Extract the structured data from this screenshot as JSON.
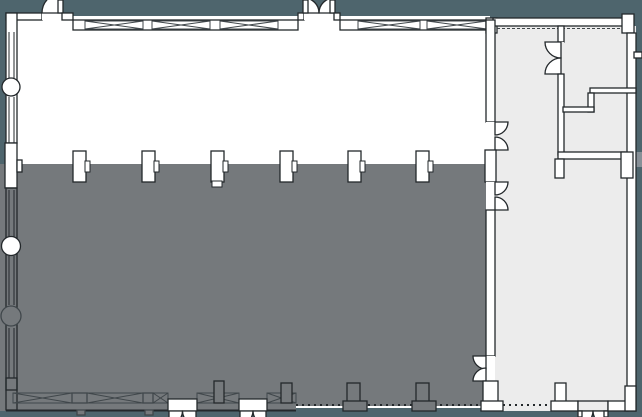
{
  "canvas": {
    "width": 642,
    "height": 417,
    "background": "#4e656d"
  },
  "palette": {
    "bg": "#4e656d",
    "floor": "#ffffff",
    "annex": "#ececec",
    "shade": "#75797c",
    "wall": "#ffffff",
    "line": "#23282b",
    "soft": "#40474b",
    "ghost": "#879097",
    "none": "none"
  },
  "regions": {
    "main_hall": {
      "x": 6,
      "y": 13,
      "w": 489,
      "h": 398
    },
    "shaded_zone": {
      "x": 0,
      "y": 164,
      "w": 486,
      "h": 247
    },
    "annex_wing": {
      "x": 486,
      "y": 14,
      "w": 156,
      "h": 397
    },
    "column_row_y": 151,
    "column_centers_x": [
      79,
      148,
      217,
      286,
      354,
      422
    ]
  },
  "floorplan": {
    "elements": [
      {
        "n": "main-hall-floor",
        "t": "rect",
        "x": 8,
        "y": 16,
        "w": 482,
        "h": 392,
        "f": "floor"
      },
      {
        "n": "annex-floor",
        "t": "rect",
        "x": 495,
        "y": 26,
        "w": 141,
        "h": 385,
        "f": "annex"
      },
      {
        "n": "shaded-zone",
        "t": "path",
        "d": "M0 164 H486 V406 H296 V411 H0 Z",
        "f": "shade"
      },
      {
        "n": "exterior-ledge",
        "t": "rect",
        "x": 636,
        "y": 152,
        "w": 6,
        "h": 15,
        "f": "ghost"
      },
      {
        "n": "wall-top-west",
        "t": "rect",
        "x": 6,
        "y": 13,
        "w": 36,
        "h": 7,
        "f": "wall",
        "s": "line"
      },
      {
        "n": "door-nw-threshold",
        "t": "rect",
        "x": 42,
        "y": 13,
        "w": 20,
        "h": 7,
        "f": "wall"
      },
      {
        "n": "door-nw-swing",
        "t": "path",
        "d": "M42 13 A20 20 0 0 1 62 -7 L62 13 Z",
        "f": "wall",
        "s": "line"
      },
      {
        "n": "door-nw-leaf",
        "t": "rect",
        "x": 58,
        "y": 0,
        "w": 5,
        "h": 13,
        "f": "wall",
        "s": "line"
      },
      {
        "n": "wall-top-a",
        "t": "rect",
        "x": 62,
        "y": 13,
        "w": 11,
        "h": 7,
        "f": "wall",
        "s": "line"
      },
      {
        "n": "window-band-top-west",
        "t": "rect",
        "x": 73,
        "y": 20,
        "w": 225,
        "h": 10,
        "f": "wall",
        "s": "line"
      },
      {
        "n": "window-x-panel",
        "t": "xpanel",
        "x": 85,
        "y": 21,
        "w": 58,
        "h": 8,
        "s": "soft"
      },
      {
        "n": "window-x-panel",
        "t": "xpanel",
        "x": 152,
        "y": 21,
        "w": 58,
        "h": 8,
        "s": "soft"
      },
      {
        "n": "window-x-panel",
        "t": "xpanel",
        "x": 220,
        "y": 21,
        "w": 58,
        "h": 8,
        "s": "soft"
      },
      {
        "n": "door-n-pier-west",
        "t": "rect",
        "x": 298,
        "y": 13,
        "w": 6,
        "h": 7,
        "f": "wall",
        "s": "line"
      },
      {
        "n": "door-n-threshold",
        "t": "rect",
        "x": 304,
        "y": 13,
        "w": 30,
        "h": 7,
        "f": "wall"
      },
      {
        "n": "door-n-swing-west",
        "t": "path",
        "d": "M319 13 A15 15 0 0 0 304 -2 L304 13 Z",
        "f": "wall",
        "s": "line"
      },
      {
        "n": "door-n-swing-east",
        "t": "path",
        "d": "M319 13 A15 15 0 0 1 334 -2 L334 13 Z",
        "f": "wall",
        "s": "line"
      },
      {
        "n": "door-n-leaf-west",
        "t": "rect",
        "x": 303,
        "y": 0,
        "w": 5,
        "h": 13,
        "f": "wall",
        "s": "line"
      },
      {
        "n": "door-n-leaf-east",
        "t": "rect",
        "x": 330,
        "y": 0,
        "w": 5,
        "h": 13,
        "f": "wall",
        "s": "line"
      },
      {
        "n": "door-n-pier-east",
        "t": "rect",
        "x": 334,
        "y": 13,
        "w": 6,
        "h": 7,
        "f": "wall",
        "s": "line"
      },
      {
        "n": "window-band-top-east",
        "t": "rect",
        "x": 340,
        "y": 20,
        "w": 153,
        "h": 10,
        "f": "wall",
        "s": "line"
      },
      {
        "n": "window-x-panel",
        "t": "xpanel",
        "x": 358,
        "y": 21,
        "w": 62,
        "h": 8,
        "s": "soft"
      },
      {
        "n": "window-x-panel",
        "t": "xpanel",
        "x": 427,
        "y": 21,
        "w": 60,
        "h": 8,
        "s": "soft"
      },
      {
        "n": "wall-annex-junction",
        "t": "rect",
        "x": 486,
        "y": 18,
        "w": 11,
        "h": 15,
        "f": "wall",
        "s": "line"
      },
      {
        "n": "wall-annex-top",
        "t": "rect",
        "x": 493,
        "y": 18,
        "w": 131,
        "h": 8,
        "f": "wall",
        "s": "line"
      },
      {
        "n": "annex-top-dashed",
        "t": "line",
        "x1": 497,
        "y1": 28.5,
        "x2": 620,
        "y2": 28.5,
        "s": "soft",
        "dash": "3 2"
      },
      {
        "n": "wall-ne-pier",
        "t": "rect",
        "x": 622,
        "y": 14,
        "w": 12,
        "h": 19,
        "f": "wall",
        "s": "line"
      },
      {
        "n": "wall-east",
        "t": "rect",
        "x": 627,
        "y": 33,
        "w": 9,
        "h": 378,
        "f": "wall",
        "s": "line"
      },
      {
        "n": "wall-ne-notch",
        "t": "rect",
        "x": 634,
        "y": 52,
        "w": 8,
        "h": 6,
        "f": "wall",
        "s": "line"
      },
      {
        "n": "wall-annex-v1-upper",
        "t": "rect",
        "x": 558,
        "y": 26,
        "w": 6,
        "h": 16,
        "f": "wall",
        "s": "line"
      },
      {
        "n": "door-annex-threshold",
        "t": "rect",
        "x": 558,
        "y": 42,
        "w": 6,
        "h": 32,
        "f": "annex"
      },
      {
        "n": "door-annex-swing-top",
        "t": "path",
        "d": "M545 42 A16 16 0 0 0 561 58 L561 42 Z",
        "f": "wall",
        "s": "line"
      },
      {
        "n": "door-annex-swing-bottom",
        "t": "path",
        "d": "M545 74 A16 16 0 0 1 561 58 L561 74 Z",
        "f": "wall",
        "s": "line"
      },
      {
        "n": "wall-annex-v1-lower",
        "t": "rect",
        "x": 558,
        "y": 74,
        "w": 6,
        "h": 81,
        "f": "wall",
        "s": "line"
      },
      {
        "n": "wall-annex-h1",
        "t": "rect",
        "x": 558,
        "y": 152,
        "w": 67,
        "h": 7,
        "f": "wall",
        "s": "line"
      },
      {
        "n": "wall-annex-h1-stub",
        "t": "rect",
        "x": 555,
        "y": 159,
        "w": 9,
        "h": 19,
        "f": "wall",
        "s": "line"
      },
      {
        "n": "wall-annex-h1-pier",
        "t": "rect",
        "x": 621,
        "y": 152,
        "w": 12,
        "h": 26,
        "f": "wall",
        "s": "line"
      },
      {
        "n": "wall-annex-step-a",
        "t": "rect",
        "x": 590,
        "y": 88,
        "w": 46,
        "h": 5,
        "f": "wall",
        "s": "line"
      },
      {
        "n": "wall-annex-step-b",
        "t": "rect",
        "x": 588,
        "y": 93,
        "w": 6,
        "h": 19,
        "f": "wall",
        "s": "line"
      },
      {
        "n": "wall-annex-step-c",
        "t": "rect",
        "x": 563,
        "y": 107,
        "w": 31,
        "h": 5,
        "f": "wall",
        "s": "line"
      },
      {
        "n": "wall-divide-upper",
        "t": "rect",
        "x": 486,
        "y": 20,
        "w": 9,
        "h": 102,
        "f": "wall",
        "s": "line"
      },
      {
        "n": "door-divide1-threshold",
        "t": "rect",
        "x": 486,
        "y": 122,
        "w": 9,
        "h": 28,
        "f": "wall"
      },
      {
        "n": "door-divide1-swing-top",
        "t": "path",
        "d": "M508 122 A13 13 0 0 1 495 135 L495 122 Z",
        "f": "wall",
        "s": "line"
      },
      {
        "n": "door-divide1-swing-bottom",
        "t": "path",
        "d": "M508 150 A13 13 0 0 0 495 137 L495 150 Z",
        "f": "wall",
        "s": "line"
      },
      {
        "n": "column-divide-pier",
        "t": "rect",
        "x": 485,
        "y": 150,
        "w": 11,
        "h": 32,
        "f": "wall",
        "s": "line"
      },
      {
        "n": "door-divide2-threshold",
        "t": "rect",
        "x": 486,
        "y": 182,
        "w": 9,
        "h": 28,
        "f": "wall"
      },
      {
        "n": "door-divide2-swing-top",
        "t": "path",
        "d": "M508 182 A13 13 0 0 1 495 195 L495 182 Z",
        "f": "wall",
        "s": "line"
      },
      {
        "n": "door-divide2-swing-bottom",
        "t": "path",
        "d": "M508 210 A13 13 0 0 0 495 197 L495 210 Z",
        "f": "wall",
        "s": "line"
      },
      {
        "n": "wall-divide-mid",
        "t": "rect",
        "x": 486,
        "y": 210,
        "w": 9,
        "h": 146,
        "f": "wall",
        "s": "line"
      },
      {
        "n": "door-divide3-threshold",
        "t": "rect",
        "x": 486,
        "y": 356,
        "w": 9,
        "h": 25,
        "f": "wall"
      },
      {
        "n": "door-divide3-swing-top",
        "t": "path",
        "d": "M473 356 A13 13 0 0 0 486 369 L486 356 Z",
        "f": "wall",
        "s": "line"
      },
      {
        "n": "door-divide3-swing-bottom",
        "t": "path",
        "d": "M473 381 A13 13 0 0 1 486 368 L486 381 Z",
        "f": "wall",
        "s": "line"
      },
      {
        "n": "wall-divide-pier-s",
        "t": "rect",
        "x": 483,
        "y": 381,
        "w": 15,
        "h": 22,
        "f": "wall",
        "s": "line"
      },
      {
        "n": "wall-divide-base",
        "t": "rect",
        "x": 481,
        "y": 401,
        "w": 22,
        "h": 10,
        "f": "wall",
        "s": "line"
      },
      {
        "n": "wall-west-upper",
        "t": "rect",
        "x": 6,
        "y": 13,
        "w": 11,
        "h": 130,
        "f": "wall",
        "s": "line"
      },
      {
        "n": "window-west-1",
        "t": "vwin",
        "x1": 9,
        "x2": 14,
        "y1": 32,
        "y2": 78,
        "s": "line"
      },
      {
        "n": "window-west-2",
        "t": "vwin",
        "x1": 9,
        "x2": 14,
        "y1": 97,
        "y2": 143,
        "s": "line"
      },
      {
        "n": "round-column-1",
        "t": "circle",
        "cx": 11,
        "cy": 87,
        "r": 9,
        "f": "wall",
        "s": "line"
      },
      {
        "n": "wall-west-pier",
        "t": "rect",
        "x": 5,
        "y": 143,
        "w": 12,
        "h": 45,
        "f": "wall",
        "s": "line"
      },
      {
        "n": "wall-west-pier-nub",
        "t": "rect",
        "x": 17,
        "y": 160,
        "w": 5,
        "h": 12,
        "f": "wall",
        "s": "line"
      },
      {
        "n": "wall-west-lower",
        "t": "rect",
        "x": 6,
        "y": 188,
        "w": 11,
        "h": 202,
        "f": "none",
        "s": "line"
      },
      {
        "n": "window-west-3",
        "t": "vwin",
        "x1": 9,
        "x2": 14,
        "y1": 190,
        "y2": 237,
        "s": "line"
      },
      {
        "n": "round-column-2",
        "t": "circle",
        "cx": 11,
        "cy": 246,
        "r": 9.5,
        "f": "wall",
        "s": "line"
      },
      {
        "n": "window-west-4",
        "t": "vwin",
        "x1": 9,
        "x2": 14,
        "y1": 256,
        "y2": 305,
        "s": "line"
      },
      {
        "n": "round-column-3",
        "t": "circle",
        "cx": 11,
        "cy": 316,
        "r": 10,
        "f": "shade",
        "s": "soft"
      },
      {
        "n": "window-west-5",
        "t": "vwin",
        "x1": 9,
        "x2": 14,
        "y1": 328,
        "y2": 378,
        "s": "line"
      },
      {
        "n": "wall-sw-corner",
        "t": "rect",
        "x": 6,
        "y": 378,
        "w": 11,
        "h": 32,
        "f": "none",
        "s": "line"
      },
      {
        "n": "column-1",
        "t": "column",
        "x": 73,
        "y": 151,
        "w": 13,
        "h": 31,
        "f": "wall",
        "s": "line"
      },
      {
        "n": "column-2",
        "t": "column",
        "x": 142,
        "y": 151,
        "w": 13,
        "h": 31,
        "f": "wall",
        "s": "line"
      },
      {
        "n": "column-3",
        "t": "column",
        "x": 211,
        "y": 151,
        "w": 13,
        "h": 31,
        "foot": true,
        "f": "wall",
        "s": "line"
      },
      {
        "n": "column-4",
        "t": "column",
        "x": 280,
        "y": 151,
        "w": 13,
        "h": 31,
        "f": "wall",
        "s": "line"
      },
      {
        "n": "column-5",
        "t": "column",
        "x": 348,
        "y": 151,
        "w": 13,
        "h": 31,
        "f": "wall",
        "s": "line"
      },
      {
        "n": "column-6",
        "t": "column",
        "x": 416,
        "y": 151,
        "w": 13,
        "h": 31,
        "f": "wall",
        "s": "line"
      },
      {
        "n": "window-band-bottom-1",
        "t": "xpanel",
        "x": 13,
        "y": 393,
        "w": 59,
        "h": 10,
        "s": "soft"
      },
      {
        "n": "pier-bottom-1",
        "t": "rect",
        "x": 72,
        "y": 393,
        "w": 15,
        "h": 10,
        "f": "none",
        "s": "soft"
      },
      {
        "n": "window-band-bottom-2",
        "t": "xpanel",
        "x": 87,
        "y": 393,
        "w": 56,
        "h": 10,
        "s": "soft"
      },
      {
        "n": "pier-bottom-2",
        "t": "rect",
        "x": 143,
        "y": 393,
        "w": 10,
        "h": 10,
        "f": "none",
        "s": "soft"
      },
      {
        "n": "window-band-bottom-3",
        "t": "xpanel",
        "x": 153,
        "y": 393,
        "w": 15,
        "h": 10,
        "s": "soft"
      },
      {
        "n": "window-band-bottom-4",
        "t": "xpanel",
        "x": 197,
        "y": 393,
        "w": 42,
        "h": 10,
        "s": "soft"
      },
      {
        "n": "window-band-bottom-5",
        "t": "xpanel",
        "x": 267,
        "y": 393,
        "w": 29,
        "h": 10,
        "s": "soft"
      },
      {
        "n": "wall-bottom-edge",
        "t": "line",
        "x1": 6,
        "y1": 410.5,
        "x2": 296,
        "y2": 410.5,
        "s": "line",
        "sw": 2
      },
      {
        "n": "door-s1-threshold",
        "t": "rect",
        "x": 168,
        "y": 399,
        "w": 29,
        "h": 12,
        "f": "wall",
        "s": "line"
      },
      {
        "n": "door-s1-swing-west",
        "t": "path",
        "d": "M182.5 411 A13.5 13.5 0 0 1 169 424.5 L169 411 Z",
        "f": "wall",
        "s": "line"
      },
      {
        "n": "door-s1-swing-east",
        "t": "path",
        "d": "M182.5 411 A13.5 13.5 0 0 0 196 424.5 L196 411 Z",
        "f": "wall",
        "s": "line"
      },
      {
        "n": "door-s2-threshold",
        "t": "rect",
        "x": 239,
        "y": 399,
        "w": 28,
        "h": 12,
        "f": "wall",
        "s": "line"
      },
      {
        "n": "door-s2-swing-west",
        "t": "path",
        "d": "M253 411 A13 13 0 0 1 240 424 L240 411 Z",
        "f": "wall",
        "s": "line"
      },
      {
        "n": "door-s2-swing-east",
        "t": "path",
        "d": "M253 411 A13 13 0 0 0 266 424 L266 411 Z",
        "f": "wall",
        "s": "line"
      },
      {
        "n": "stub-s-1",
        "t": "rect",
        "x": 77,
        "y": 410,
        "w": 8,
        "h": 5,
        "f": "shade",
        "s": "soft"
      },
      {
        "n": "stub-s-2",
        "t": "rect",
        "x": 145,
        "y": 410,
        "w": 8,
        "h": 5,
        "f": "shade",
        "s": "soft"
      },
      {
        "n": "column-s-3",
        "t": "rect",
        "x": 214,
        "y": 381,
        "w": 10,
        "h": 22,
        "f": "shade",
        "s": "line"
      },
      {
        "n": "column-s-4",
        "t": "rect",
        "x": 281,
        "y": 383,
        "w": 11,
        "h": 20,
        "f": "shade",
        "s": "line"
      },
      {
        "n": "edge-dotted-1",
        "t": "line",
        "x1": 296,
        "y1": 405,
        "x2": 481,
        "y2": 405,
        "s": "line",
        "dash": "2 4",
        "sw": 2
      },
      {
        "n": "edge-dotted-2",
        "t": "line",
        "x1": 503,
        "y1": 405,
        "x2": 551,
        "y2": 405,
        "s": "line",
        "dash": "2 4",
        "sw": 2
      },
      {
        "n": "column-s-5",
        "t": "rect",
        "x": 347,
        "y": 383,
        "w": 13,
        "h": 20,
        "f": "shade",
        "s": "line"
      },
      {
        "n": "column-s-5-base",
        "t": "rect",
        "x": 343,
        "y": 401,
        "w": 24,
        "h": 10,
        "f": "shade",
        "s": "line"
      },
      {
        "n": "column-s-6",
        "t": "rect",
        "x": 416,
        "y": 383,
        "w": 13,
        "h": 20,
        "f": "shade",
        "s": "line"
      },
      {
        "n": "column-s-6-base",
        "t": "rect",
        "x": 412,
        "y": 401,
        "w": 24,
        "h": 10,
        "f": "shade",
        "s": "line"
      },
      {
        "n": "pier-annex-s",
        "t": "rect",
        "x": 555,
        "y": 383,
        "w": 11,
        "h": 20,
        "f": "wall",
        "s": "line"
      },
      {
        "n": "pier-annex-s-base",
        "t": "rect",
        "x": 551,
        "y": 401,
        "w": 27,
        "h": 10,
        "f": "wall",
        "s": "line"
      },
      {
        "n": "door-se-threshold",
        "t": "rect",
        "x": 578,
        "y": 401,
        "w": 30,
        "h": 10,
        "f": "annex",
        "s": "line"
      },
      {
        "n": "door-se-swing-west",
        "t": "path",
        "d": "M593 411 A14 14 0 0 1 579 425 L579 411 Z",
        "f": "wall",
        "s": "line"
      },
      {
        "n": "door-se-swing-east",
        "t": "path",
        "d": "M593 411 A14 14 0 0 0 607 425 L607 411 Z",
        "f": "wall",
        "s": "line"
      },
      {
        "n": "door-se-leaf-west",
        "t": "rect",
        "x": 578,
        "y": 411,
        "w": 4,
        "h": 6,
        "f": "wall",
        "s": "line"
      },
      {
        "n": "door-se-leaf-east",
        "t": "rect",
        "x": 604,
        "y": 411,
        "w": 4,
        "h": 6,
        "f": "wall",
        "s": "line"
      },
      {
        "n": "wall-annex-s",
        "t": "rect",
        "x": 608,
        "y": 401,
        "w": 20,
        "h": 10,
        "f": "wall",
        "s": "line"
      },
      {
        "n": "wall-se-pier",
        "t": "rect",
        "x": 625,
        "y": 386,
        "w": 11,
        "h": 25,
        "f": "wall",
        "s": "line"
      }
    ]
  }
}
